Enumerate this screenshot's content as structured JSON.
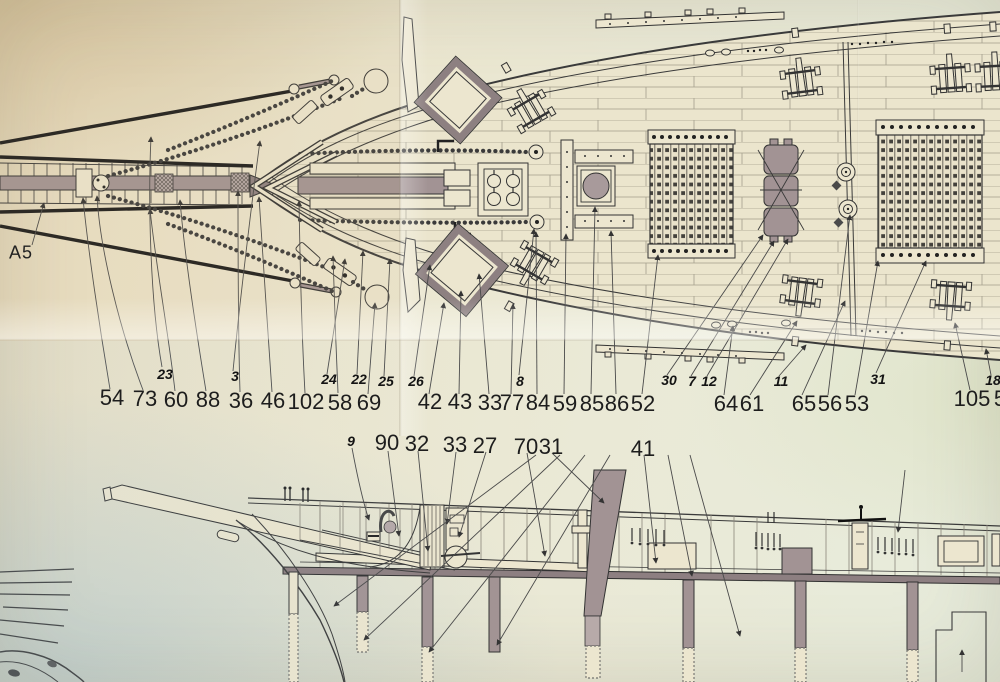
{
  "colors": {
    "paper": "#ebe6d2",
    "paper_warm": "#e8dcc0",
    "paper_cool": "#dde4e4",
    "ink": "#2b2b2b",
    "wood_gray": "#a29394",
    "deck_band": "#8d7f81"
  },
  "annotations": {
    "view_ref_label": "A5",
    "deck_plan": {
      "italic_part_numbers": [
        "23",
        "3",
        "24",
        "22",
        "25",
        "26",
        "8",
        "30",
        "7",
        "12",
        "11",
        "31",
        "18"
      ],
      "part_numbers": [
        "54",
        "73",
        "60",
        "88",
        "36",
        "46",
        "102",
        "58",
        "69",
        "42",
        "43",
        "33",
        "77",
        "84",
        "59",
        "85",
        "86",
        "52",
        "64",
        "61",
        "65",
        "56",
        "53",
        "105",
        "5"
      ]
    },
    "profile": {
      "italic_part_numbers": [
        "9"
      ],
      "part_numbers": [
        "90",
        "32",
        "33",
        "27",
        "70",
        "31",
        "41"
      ]
    }
  }
}
